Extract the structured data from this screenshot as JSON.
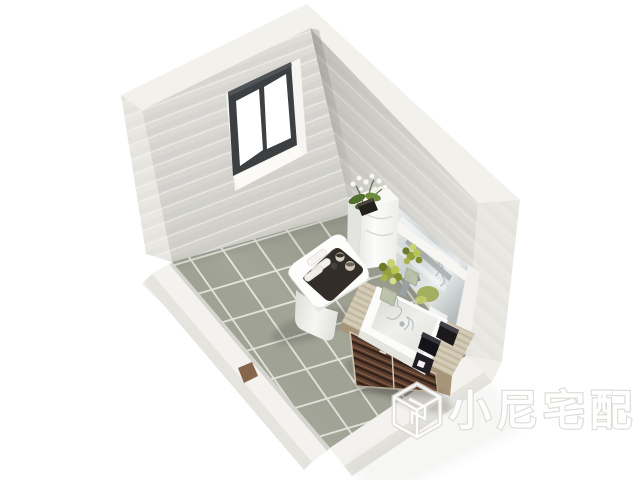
{
  "meta": {
    "description": "3D isometric interior rendering of a small bathroom with tiled floor, window, toilet and wood vanity",
    "style": "white cut-away walls, grey ceramic floor tiles"
  },
  "watermark": {
    "text": "小尼宅配",
    "logo": "isometric-cube-logo"
  },
  "room": {
    "window": {
      "panes": 2,
      "frame": "dark grey aluminium",
      "wall": "upper-left"
    },
    "floor": {
      "material": "square ceramic tiles",
      "layout": "diagonal grid"
    },
    "door_threshold": "small brown strip on lower-left cut wall",
    "objects": [
      "toilet with square lid",
      "dark tray on toilet lid with rolled towels and jars",
      "white orchid plant in black pot on cistern",
      "wall mirror above vanity",
      "wood vanity cabinet with dark slatted drawers",
      "white rectangular vessel sink with chrome faucet",
      "two green flower arrangements in vases",
      "black accessory boxes on counter"
    ]
  },
  "colors": {
    "wall_light": "#dcdad4",
    "wall_right": "#cdcbc5",
    "wall_top": "#f2f1ec",
    "wall_end": "#e9e7e1",
    "tile": "#a6a79a",
    "grout": "#e9eae2",
    "ledge": "#f3f2ee",
    "ledge_side": "#e6e4de",
    "window_frame": "#3d4043",
    "glass": "#ffffff",
    "fixture_white": "#fbfbfa",
    "tray_dark": "#322d28",
    "wood_light": "#cfc6b0",
    "wood_dark": "#4a3226",
    "wood_mid": "#a89478",
    "plant_green": "#93a23c",
    "leaf_green": "#53702e",
    "accessory_black": "#1b191c",
    "threshold": "#86664c",
    "chrome": "#8f969a",
    "mirror_tint": "#c9cfd0",
    "watermark_outline": "#dcd9d3"
  }
}
